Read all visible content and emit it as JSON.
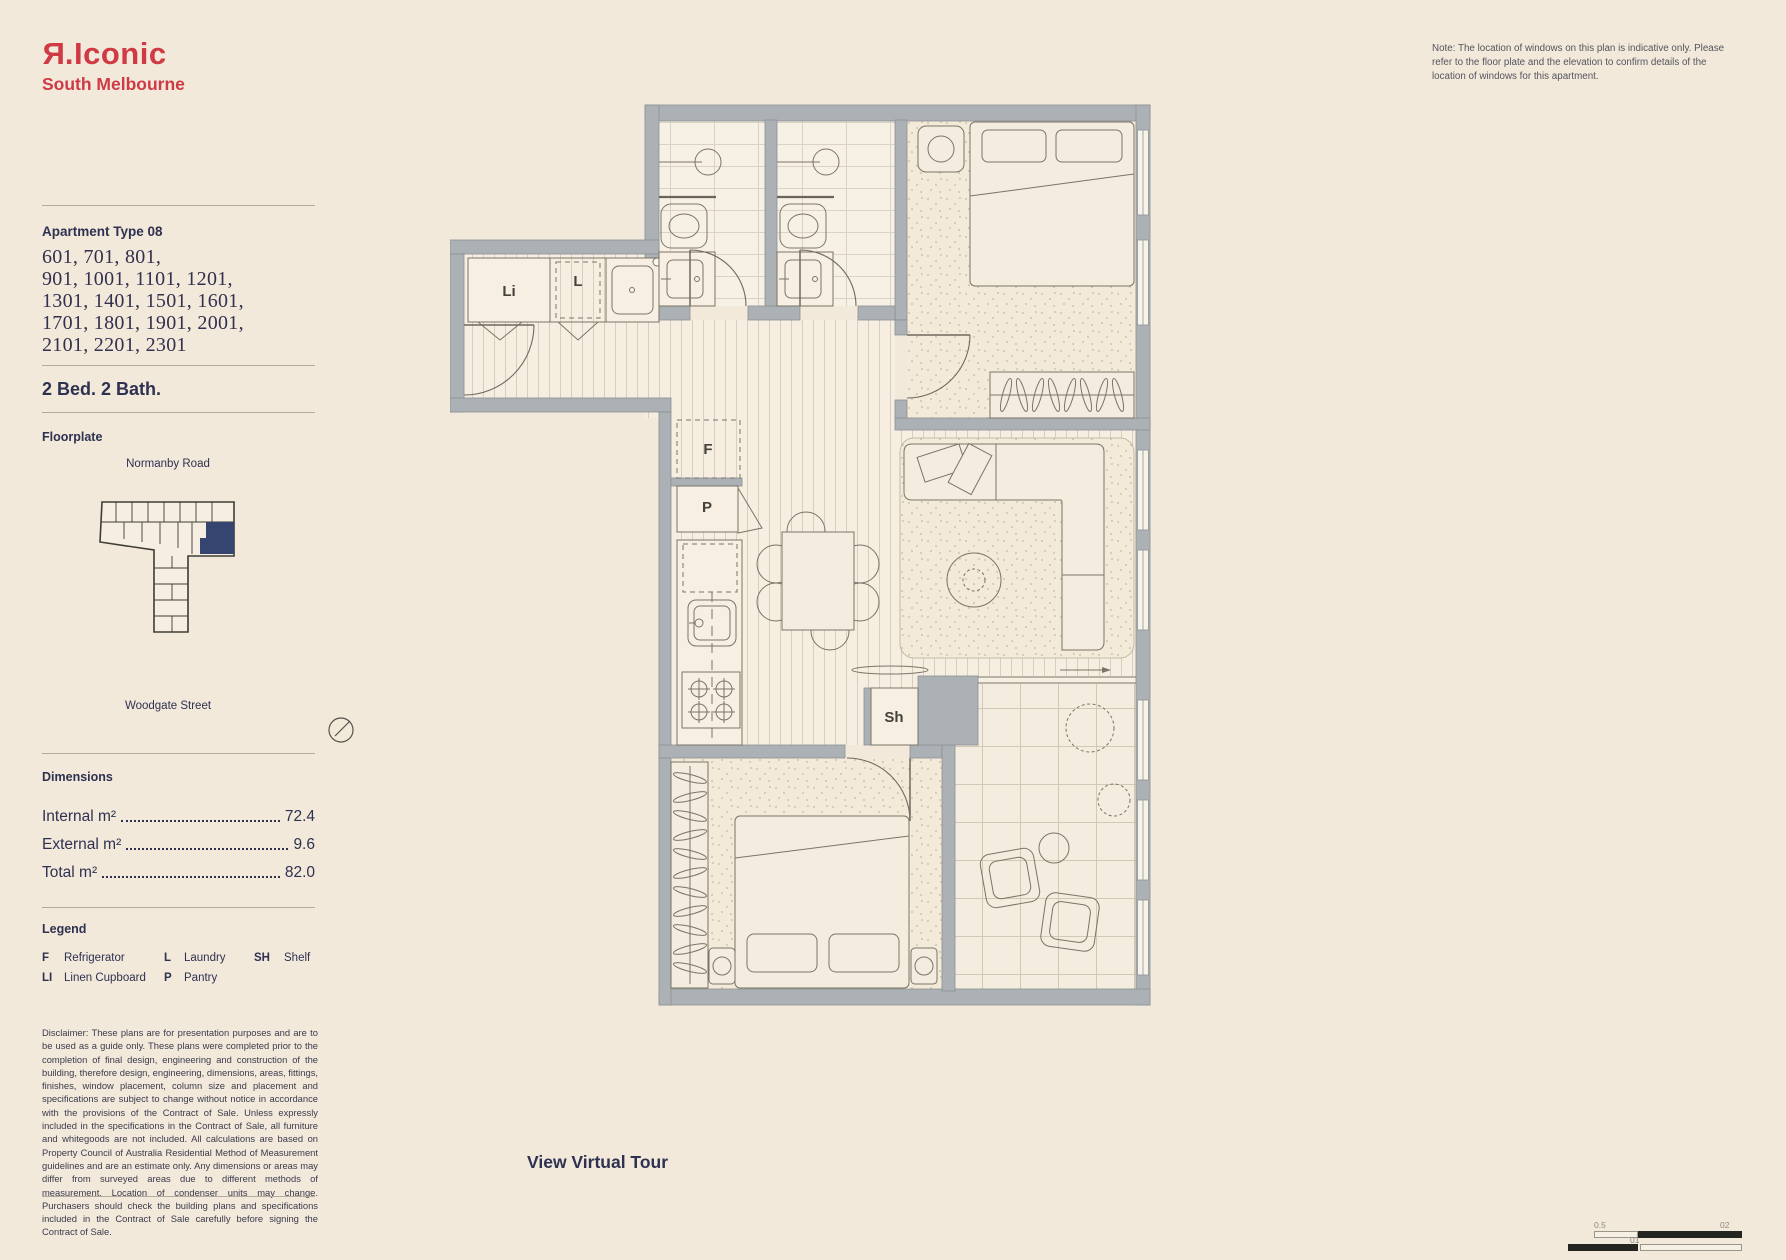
{
  "brand": {
    "logo_r": "R",
    "logo_rest": ".Iconic",
    "location": "South Melbourne"
  },
  "note": "Note: The location of windows on this plan is indicative only. Please refer to the floor plate and the elevation to confirm details of the location of windows for this apartment.",
  "sidebar": {
    "apartment_type": "Apartment Type 08",
    "units_lines": [
      "601, 701, 801,",
      "901, 1001, 1101, 1201,",
      "1301, 1401, 1501, 1601,",
      "1701, 1801, 1901, 2001,",
      "2101, 2201, 2301"
    ],
    "config": "2 Bed. 2 Bath.",
    "floorplate_heading": "Floorplate",
    "road_top": "Normanby Road",
    "road_bottom": "Woodgate Street",
    "dimensions_heading": "Dimensions",
    "dimensions": [
      {
        "label": "Internal m²",
        "value": "72.4"
      },
      {
        "label": "External m²",
        "value": "9.6"
      },
      {
        "label": "Total m²",
        "value": "82.0"
      }
    ],
    "legend_heading": "Legend",
    "legend": [
      {
        "key": "F",
        "label": "Refrigerator"
      },
      {
        "key": "L",
        "label": "Laundry"
      },
      {
        "key": "SH",
        "label": "Shelf"
      },
      {
        "key": "LI",
        "label": "Linen Cupboard"
      },
      {
        "key": "P",
        "label": "Pantry"
      }
    ],
    "disclaimer": "Disclaimer: These plans are for presentation purposes and are to be used as a guide only. These plans were completed prior to the completion of final design, engineering and construction of the building, therefore design, engineering, dimensions, areas, fittings, finishes, window placement, column size and placement and specifications are subject to change without notice in accordance with the provisions of the Contract of Sale. Unless expressly included in the specifications in the Contract of Sale, all furniture and whitegoods are not included. All calculations are based on Property Council of Australia Residential Method of Measurement guidelines and are an estimate only. Any dimensions or areas may differ from surveyed areas due to different methods of measurement. Location of condenser units may change. Purchasers should check the building plans and specifications included in the Contract of Sale carefully before signing the Contract of Sale."
  },
  "plan": {
    "labels": {
      "linen": "Li",
      "laundry": "L",
      "fridge": "F",
      "pantry": "P",
      "shelf": "Sh"
    }
  },
  "virtual_tour": "View Virtual Tour",
  "scalebar": {
    "label_left": "0.5",
    "label_mid": "01",
    "label_right": "02"
  },
  "colors": {
    "background": "#f2e9db",
    "brand_red": "#cf3a45",
    "navy_text": "#2e3150",
    "wall_gray": "#abb1b5",
    "unit_highlight": "#36456f"
  }
}
